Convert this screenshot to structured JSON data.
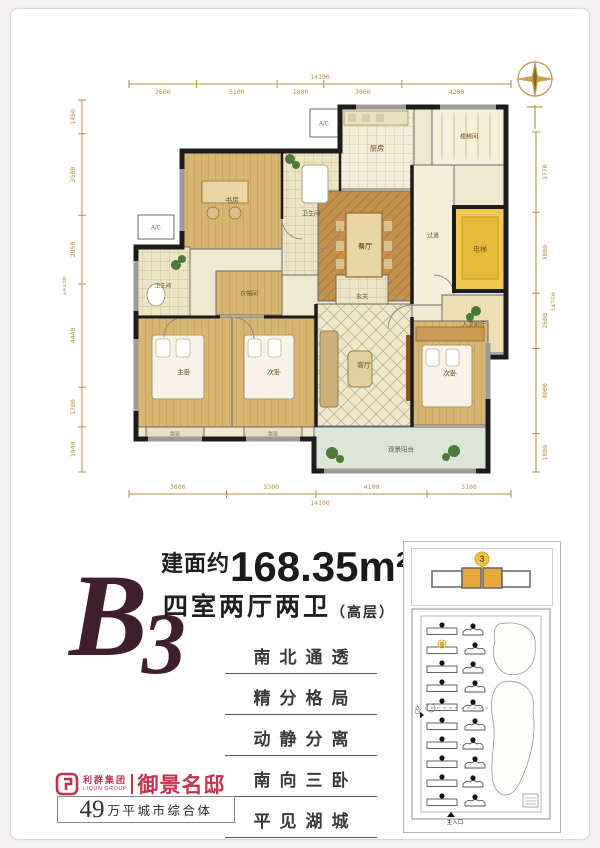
{
  "floorplan": {
    "compass": "compass-rose-icon",
    "dimensions": {
      "top": {
        "total": "14100",
        "segments": [
          "2600",
          "3100",
          "1800",
          "3000",
          "4200"
        ]
      },
      "bottom": {
        "total": "14100",
        "segments": [
          "3600",
          "3300",
          "4100",
          "3100"
        ]
      },
      "left": {
        "total": "14150",
        "segments": [
          "1450",
          "3500",
          "2950",
          "4440",
          "1700",
          "1940"
        ]
      },
      "right": {
        "total": "14750",
        "segments": [
          "3770",
          "3800",
          "2600",
          "4000",
          "1800"
        ]
      }
    },
    "rooms": [
      {
        "label": "书房",
        "x": 58,
        "y": 52,
        "w": 100,
        "h": 98,
        "fill": "#d8b571",
        "pattern": "wood"
      },
      {
        "label": "卫生间",
        "x": 158,
        "y": 52,
        "w": 58,
        "h": 124,
        "fill": "#eee4c6",
        "pattern": "tile",
        "fs": 6
      },
      {
        "label": "厨房",
        "x": 216,
        "y": 8,
        "w": 74,
        "h": 82,
        "fill": "#f3ecd6",
        "pattern": "tile"
      },
      {
        "label": "餐厅",
        "x": 194,
        "y": 92,
        "w": 94,
        "h": 110,
        "fill": "#c3914d",
        "pattern": "rug",
        "tc": "#3f2c10"
      },
      {
        "label": "楼梯间",
        "x": 308,
        "y": 8,
        "w": 74,
        "h": 58,
        "fill": "#f6f0da",
        "fs": 6
      },
      {
        "label": "过道",
        "x": 288,
        "y": 66,
        "w": 42,
        "h": 140,
        "fill": "#f6f0da",
        "fs": 6
      },
      {
        "label": "电梯",
        "x": 330,
        "y": 108,
        "w": 52,
        "h": 84,
        "fill": "#f1c84f",
        "tc": "#7a5a14"
      },
      {
        "label": "入室前厅",
        "x": 318,
        "y": 196,
        "w": 64,
        "h": 58,
        "fill": "#eedfb2",
        "fs": 6
      },
      {
        "label": "卫生间",
        "x": 12,
        "y": 148,
        "w": 54,
        "h": 76,
        "fill": "#eee4c6",
        "pattern": "tile",
        "fs": 5.5
      },
      {
        "label": "衣帽间",
        "x": 92,
        "y": 172,
        "w": 66,
        "h": 44,
        "fill": "#d8b571",
        "pattern": "wood",
        "fs": 6
      },
      {
        "label": "玄关",
        "x": 212,
        "y": 176,
        "w": 52,
        "h": 42,
        "fill": "#eee4c6",
        "pattern": "tile",
        "fs": 6
      },
      {
        "label": "主卧",
        "x": 12,
        "y": 218,
        "w": 96,
        "h": 110,
        "fill": "#d8b571",
        "pattern": "wood"
      },
      {
        "label": "次卧",
        "x": 108,
        "y": 218,
        "w": 84,
        "h": 110,
        "fill": "#d8b571",
        "pattern": "wood"
      },
      {
        "label": "客厅",
        "x": 192,
        "y": 205,
        "w": 96,
        "h": 122,
        "fill": "#efe8cd",
        "pattern": "diamond"
      },
      {
        "label": "次卧",
        "x": 288,
        "y": 222,
        "w": 76,
        "h": 104,
        "fill": "#d8b571",
        "pattern": "wood"
      },
      {
        "label": "观景阳台",
        "x": 190,
        "y": 328,
        "w": 174,
        "h": 44,
        "fill": "#dce6d8",
        "fs": 6.5,
        "tc": "#55604f"
      },
      {
        "label": "飘窗",
        "x": 22,
        "y": 328,
        "w": 58,
        "h": 12,
        "fill": "#e9dfc2",
        "fs": 5,
        "tc": "#8a7a4a"
      },
      {
        "label": "飘窗",
        "x": 120,
        "y": 328,
        "w": 58,
        "h": 12,
        "fill": "#e9dfc2",
        "fs": 5,
        "tc": "#8a7a4a"
      },
      {
        "label": "A/C",
        "x": 14,
        "y": 116,
        "w": 36,
        "h": 24,
        "fill": "#ffffff",
        "fs": 6,
        "tc": "#777777"
      },
      {
        "label": "A/C",
        "x": 186,
        "y": 10,
        "w": 28,
        "h": 28,
        "fill": "#ffffff",
        "fs": 6,
        "tc": "#777777"
      }
    ],
    "colors": {
      "wall": "#1c1c1c",
      "window": "#9b9b9b",
      "dimension": "#b5924a",
      "floorBase": "#f0e8cf"
    }
  },
  "info": {
    "unit_code": "B3",
    "area_prefix": "建面约",
    "area_value": "168.35m²",
    "layout": "四室两厅两卫",
    "layout_note": "（高层）",
    "selling_points": [
      "南北通透",
      "精分格局",
      "动静分离",
      "南向三卧",
      "平见湖城"
    ]
  },
  "brand": {
    "group_cn": "利群集团",
    "group_en": "LIQUN GROUP",
    "project_name": "御景名邸",
    "tagline_number": "49",
    "tagline_text": "万平城市综合体",
    "brand_color": "#c2334d"
  },
  "site_map": {
    "key_unit_number": "3",
    "entrance_left": "入口",
    "entrance_main": "主入口",
    "highlight_color": "#e8a93c",
    "rows": 10,
    "columns": 2
  }
}
